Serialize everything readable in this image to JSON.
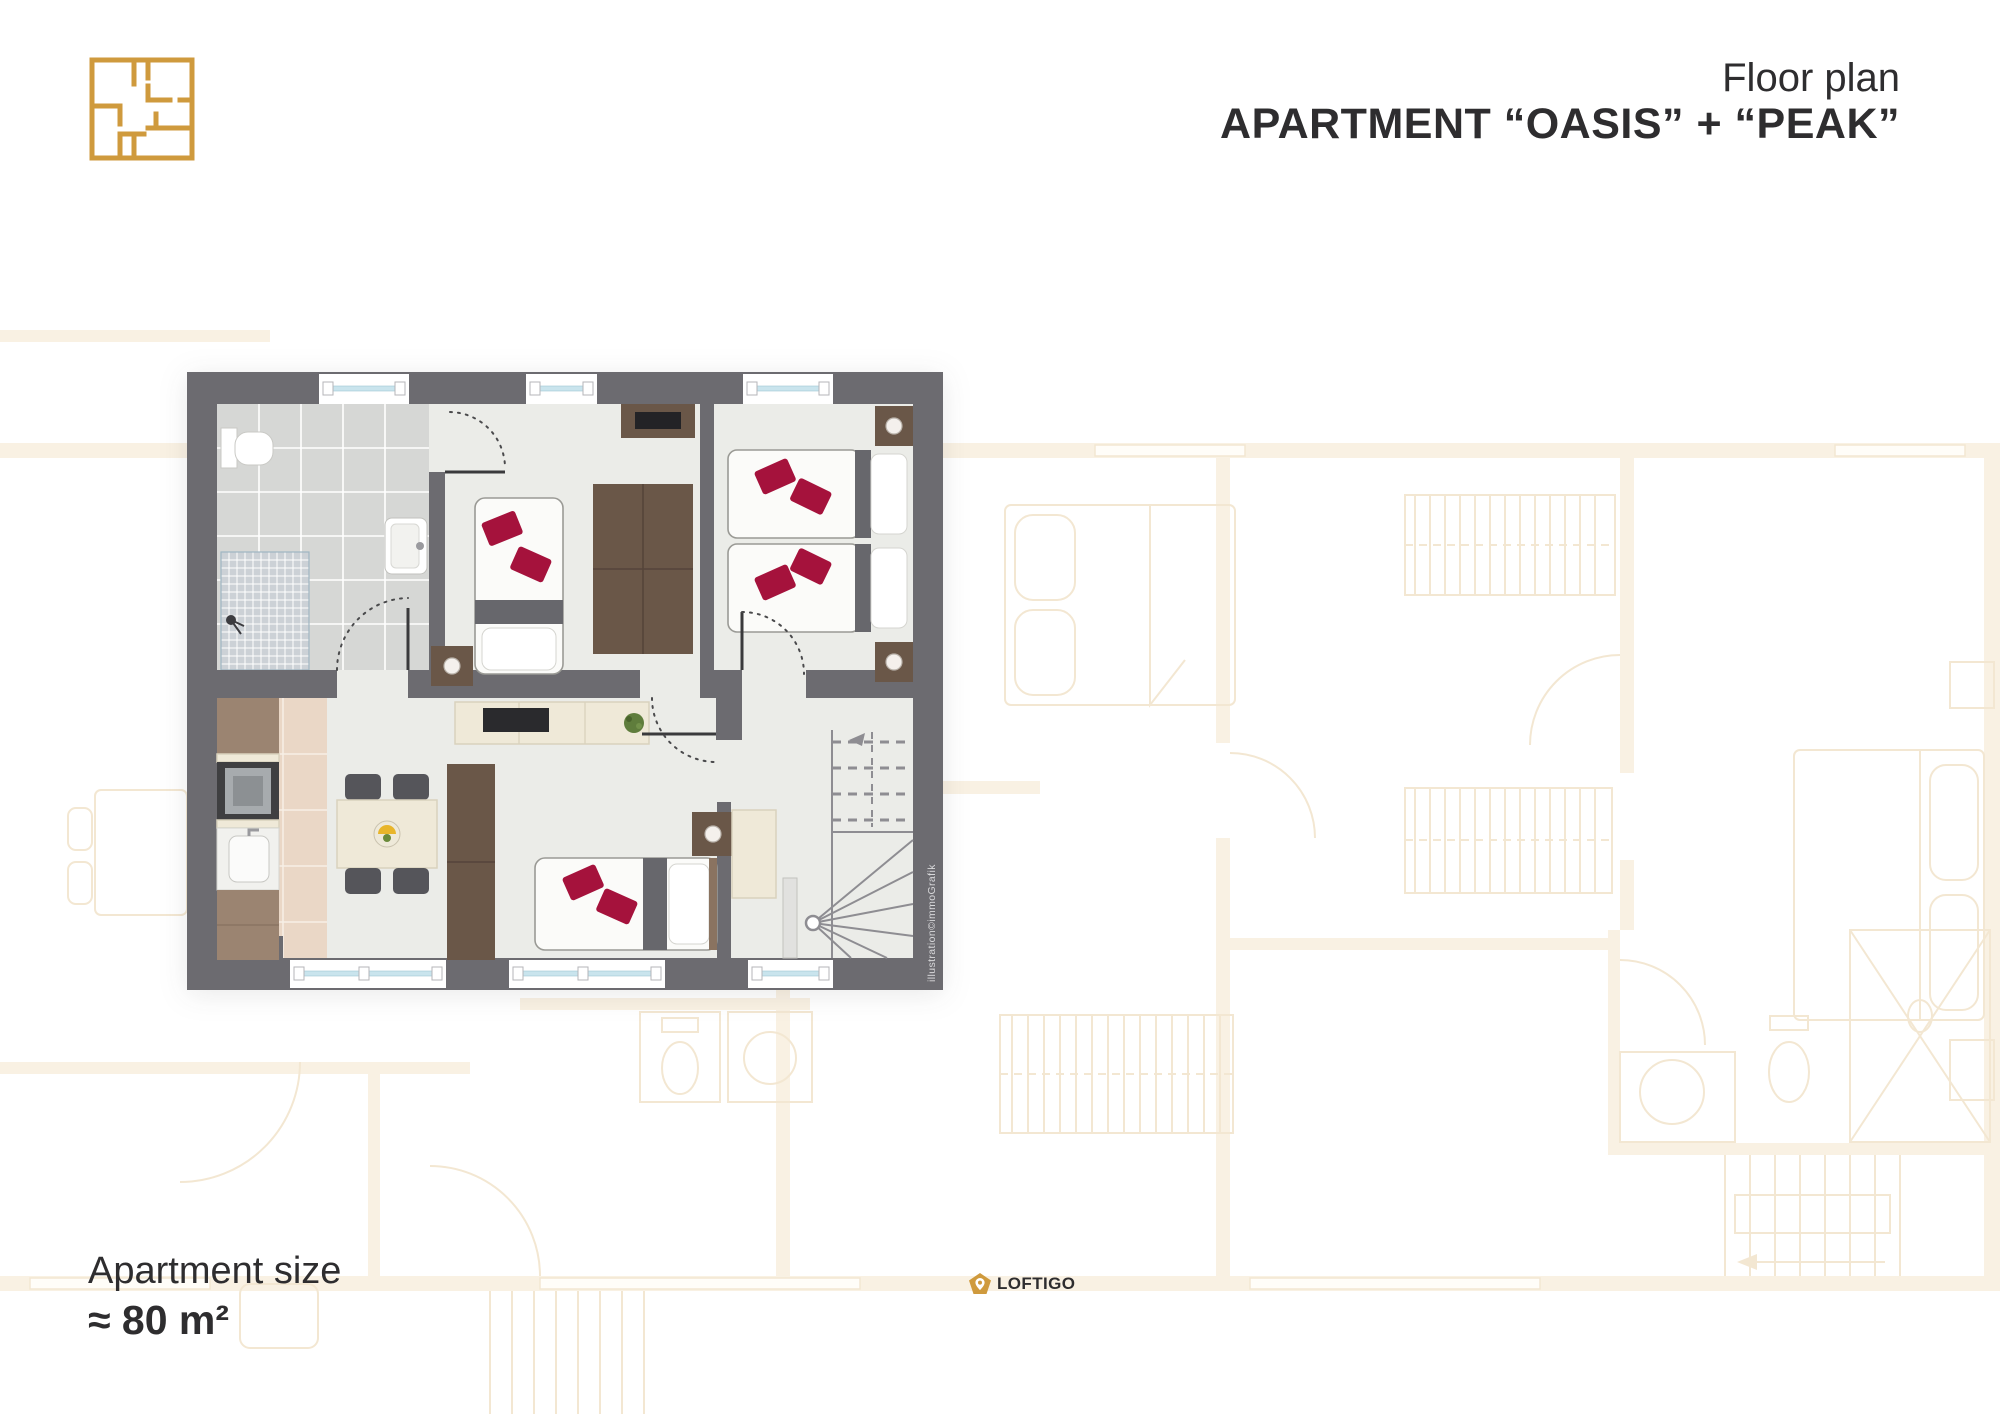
{
  "header": {
    "logo_icon": "floorplan-outline-icon",
    "title_line1": "Floor plan",
    "title_line2": "APARTMENT “OASIS” + “PEAK”"
  },
  "footer": {
    "size_label": "Apartment size",
    "size_value": "≈ 80 m²",
    "brand_name": "LOFTIGO",
    "brand_icon": "shield-location-pin-icon"
  },
  "plan": {
    "credit": "illustration©immoGrafik"
  },
  "colors": {
    "ink": "#2e2d2f",
    "gold": "#cf9a3d",
    "wall": "#6c6b70",
    "floor": "#ebece8",
    "tile": "#d6d7d5",
    "tileLine": "#ffffff",
    "mosaic": "#ccd1d6",
    "kitchen": "#ead7c6",
    "woodDark": "#6a5748",
    "woodMid": "#9b8471",
    "cream": "#efe9d8",
    "creamStroke": "#d9d2bd",
    "red": "#a5123c",
    "glass": "#c9e4ed",
    "darkBand": "#67676c",
    "bedStroke": "#9a9a95",
    "stair": "#8e8d92",
    "bgLine": "#f3e7d2",
    "bgFill": "#f9f1e3"
  }
}
